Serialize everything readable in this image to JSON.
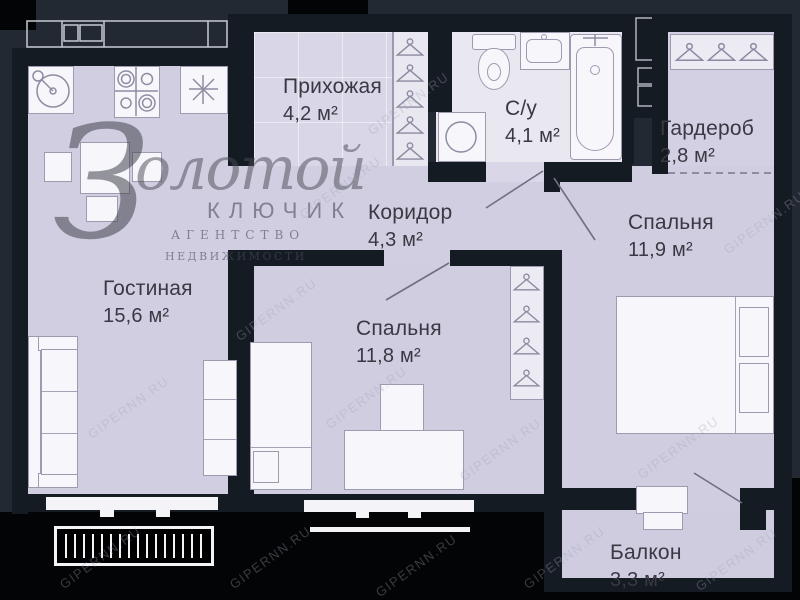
{
  "rooms": [
    {
      "name": "Прихожая",
      "area": "4,2 м²"
    },
    {
      "name": "С/у",
      "area": "4,1 м²"
    },
    {
      "name": "Гардероб",
      "area": "2,8 м²"
    },
    {
      "name": "Коридор",
      "area": "4,3 м²"
    },
    {
      "name": "Спальня",
      "area": "11,9 м²"
    },
    {
      "name": "Гостиная",
      "area": "15,6 м²"
    },
    {
      "name": "Спальня",
      "area": "11,8 м²"
    },
    {
      "name": "Балкон",
      "area": "3,3 м²"
    }
  ],
  "watermark": {
    "logo_initial": "З",
    "logo_script": "олотой",
    "logo_subtitle": "КЛЮЧИК",
    "logo_tagline_1": "агентство",
    "logo_tagline_2": "недвижимости",
    "site": "GIPERNN.RU"
  },
  "colors": {
    "background": "#222933",
    "exterior_black": "#030405",
    "wall": "#151b22",
    "floor": "#d1cee1",
    "floor_light": "#e9e8f1",
    "fixture": "#f7f6fb",
    "label_text": "#393843"
  }
}
